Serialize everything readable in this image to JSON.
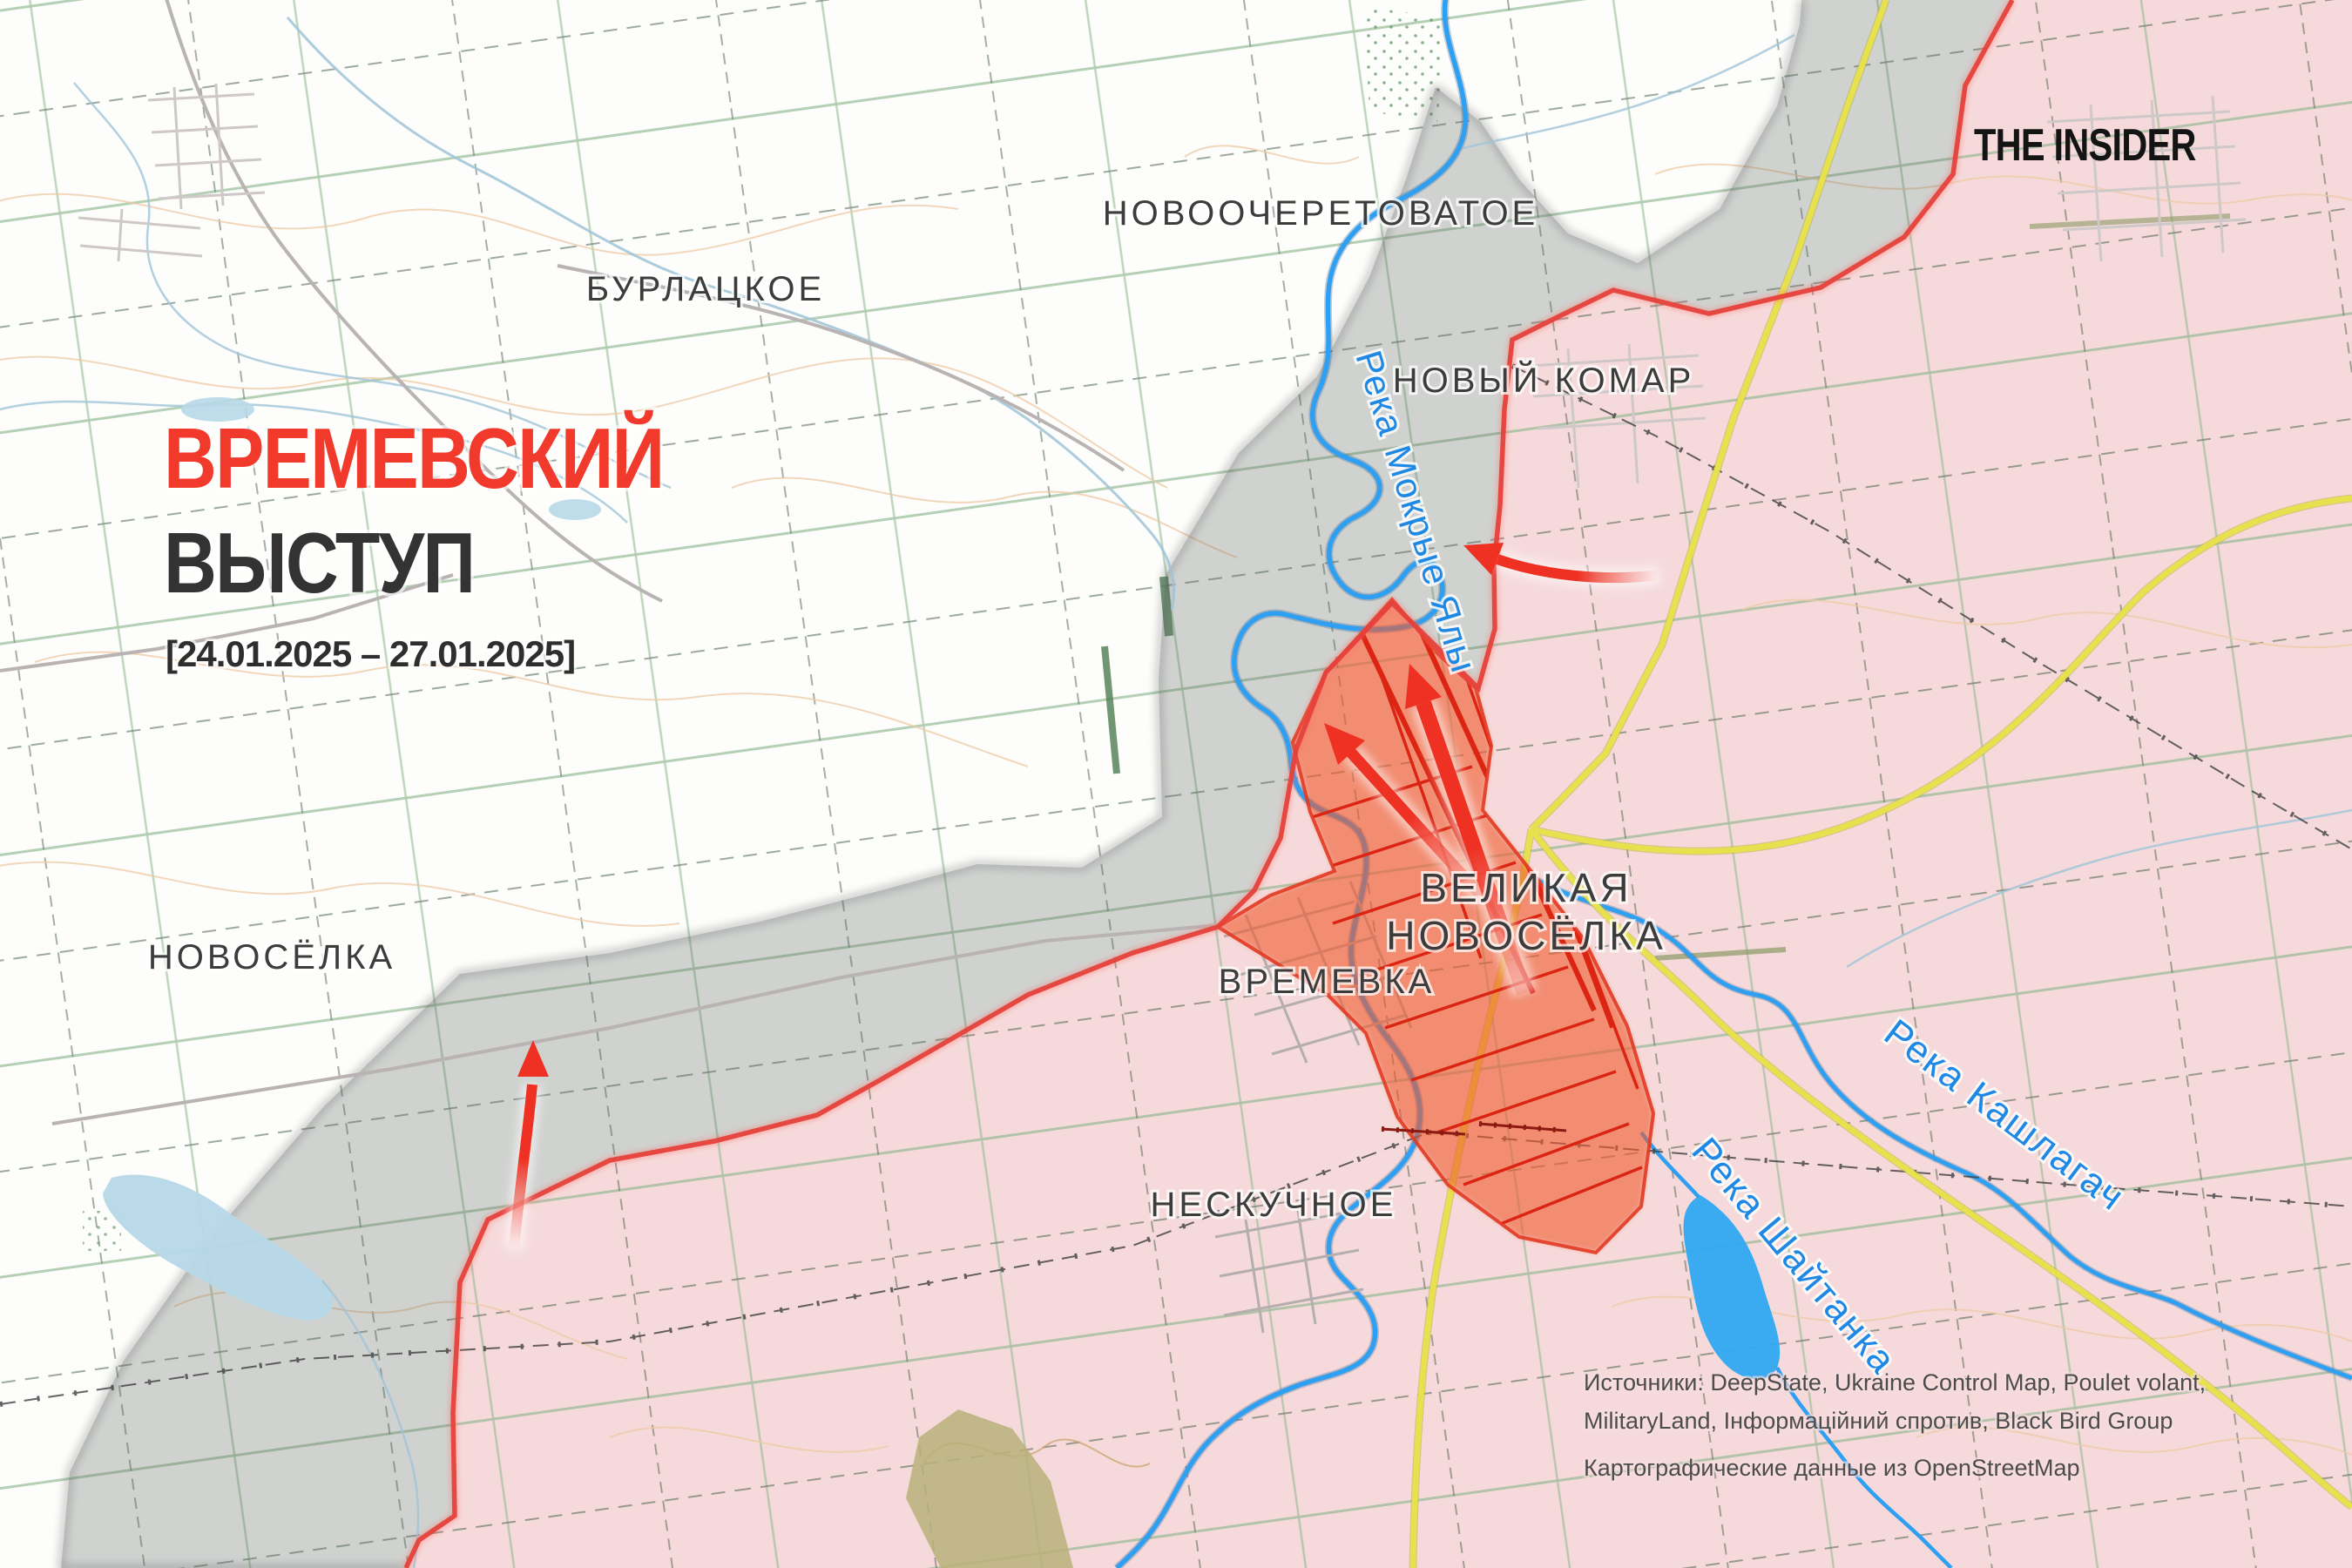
{
  "title": {
    "line1": "ВРЕМЕВСКИЙ",
    "line2": "ВЫСТУП",
    "dates": "[24.01.2025 – 27.01.2025]"
  },
  "logo": {
    "text": "THE INSIDER"
  },
  "places": {
    "novoocheretovatoe": "НОВООЧЕРЕТОВАТОЕ",
    "burlatskoe": "БУРЛАЦКОЕ",
    "novy_komar": "НОВЫЙ КОМАР",
    "novosyolka": "НОВОСЁЛКА",
    "velyka_line1": "ВЕЛИКАЯ",
    "velyka_line2": "НОВОСЁЛКА",
    "vremevka": "ВРЕМЕВКА",
    "neskuchnoe": "НЕСКУЧНОЕ"
  },
  "rivers": {
    "mokrye_yaly": "Река Мокрые Ялы",
    "kashlagach": "Река Кашлагач",
    "shaytanka": "Река Шайтанка"
  },
  "sources": {
    "line1": "Источники: DeepState, Ukraine Control Map, Poulet volant,",
    "line2": "MilitaryLand, Інформаційний спротив, Black Bird Group",
    "line3": "Картографические данные из OpenStreetMap"
  },
  "colors": {
    "title_accent": "#f23a2c",
    "title_dark": "#333333",
    "occupied_fill": "#f8dada",
    "contested_fill": "#d8d8d6",
    "advance_fill": "#f4794f",
    "front_line": "#e5413b",
    "attack_arrow": "#ee3123",
    "river_blue": "#2f9ff2",
    "river_label_blue": "#1e88e5",
    "road_major_yellow": "#e7e14e",
    "field_border_green": "#8cb68c",
    "contour_tan": "#eec9a4"
  }
}
